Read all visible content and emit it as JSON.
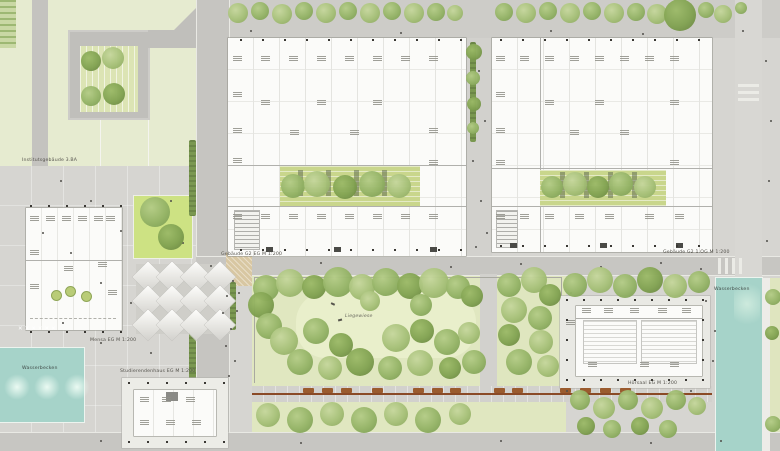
{
  "labels": {
    "institute": "Institutsgebäude 3.BA",
    "building_g2_eg": "Gebäude G2 EG M 1:200",
    "building_g2_og": "Gebäude G2 1.OG M 1:200",
    "mensa": "Mensa EG M 1:200",
    "studierendenhaus": "Studierendenhaus EG M 1:200",
    "hoersaal": "Hörsaal EG M 1:200",
    "liegewiese": "Liegewiese",
    "water_right": "Wasserbecken",
    "water_left": "Wasserbecken",
    "x_marks": "✕ ✕ ✕ ✕ ✕ ✕"
  },
  "colors": {
    "paving": "#d6d5d1",
    "road": "#c7c6c2",
    "lawn": "#e2e9c4",
    "roof_garden": "#c9d68c",
    "tree_green": "#94b366",
    "water_teal": "#a6d3c9",
    "building_white": "#fbfbf9",
    "bench_brown": "#9a5b2e",
    "sand": "#d8c7a2"
  },
  "scene": {
    "tree_palette": [
      [
        "#c6d79d",
        "#a6c078",
        "#89a65c"
      ],
      [
        "#b4cc87",
        "#94b366",
        "#789950"
      ],
      [
        "#9cba68",
        "#81a251",
        "#66823e"
      ]
    ],
    "trees": [
      [
        238,
        13,
        10,
        0
      ],
      [
        260,
        11,
        9,
        1
      ],
      [
        282,
        14,
        10,
        0
      ],
      [
        304,
        11,
        9,
        1
      ],
      [
        326,
        13,
        10,
        0
      ],
      [
        348,
        11,
        9,
        1
      ],
      [
        370,
        13,
        10,
        0
      ],
      [
        392,
        11,
        9,
        1
      ],
      [
        414,
        13,
        10,
        0
      ],
      [
        436,
        12,
        9,
        1
      ],
      [
        455,
        13,
        8,
        0
      ],
      [
        504,
        12,
        9,
        1
      ],
      [
        526,
        13,
        10,
        0
      ],
      [
        548,
        11,
        9,
        1
      ],
      [
        570,
        13,
        10,
        0
      ],
      [
        592,
        11,
        9,
        1
      ],
      [
        614,
        13,
        10,
        0
      ],
      [
        636,
        12,
        9,
        1
      ],
      [
        657,
        14,
        10,
        0
      ],
      [
        680,
        15,
        16,
        2
      ],
      [
        706,
        10,
        8,
        1
      ],
      [
        723,
        14,
        9,
        0
      ],
      [
        741,
        8,
        6,
        1
      ],
      [
        474,
        52,
        8,
        2
      ],
      [
        473,
        78,
        7,
        1
      ],
      [
        474,
        104,
        7,
        2
      ],
      [
        473,
        128,
        6,
        1
      ],
      [
        293,
        186,
        12,
        1
      ],
      [
        317,
        184,
        13,
        0
      ],
      [
        345,
        187,
        12,
        2
      ],
      [
        372,
        184,
        13,
        1
      ],
      [
        399,
        186,
        12,
        0
      ],
      [
        552,
        187,
        11,
        1
      ],
      [
        575,
        184,
        12,
        0
      ],
      [
        598,
        187,
        11,
        2
      ],
      [
        621,
        184,
        12,
        1
      ],
      [
        645,
        187,
        11,
        0
      ],
      [
        91,
        61,
        10,
        2
      ],
      [
        113,
        58,
        11,
        0
      ],
      [
        91,
        96,
        10,
        1
      ],
      [
        114,
        94,
        11,
        2
      ],
      [
        155,
        212,
        15,
        1
      ],
      [
        171,
        237,
        13,
        2
      ],
      [
        773,
        297,
        8,
        1
      ],
      [
        772,
        333,
        7,
        2
      ],
      [
        773,
        424,
        8,
        1
      ],
      [
        266,
        288,
        13,
        1
      ],
      [
        290,
        283,
        14,
        0
      ],
      [
        314,
        287,
        12,
        2
      ],
      [
        338,
        282,
        15,
        1
      ],
      [
        362,
        287,
        13,
        0
      ],
      [
        386,
        282,
        14,
        1
      ],
      [
        410,
        286,
        13,
        2
      ],
      [
        434,
        283,
        15,
        0
      ],
      [
        458,
        287,
        12,
        1
      ],
      [
        472,
        296,
        11,
        2
      ],
      [
        261,
        305,
        13,
        2
      ],
      [
        269,
        326,
        13,
        1
      ],
      [
        284,
        341,
        14,
        0
      ],
      [
        316,
        331,
        13,
        1
      ],
      [
        341,
        345,
        12,
        2
      ],
      [
        370,
        301,
        10,
        0
      ],
      [
        421,
        305,
        11,
        1
      ],
      [
        396,
        338,
        14,
        0
      ],
      [
        422,
        331,
        12,
        2
      ],
      [
        447,
        342,
        13,
        1
      ],
      [
        469,
        333,
        11,
        0
      ],
      [
        300,
        362,
        13,
        1
      ],
      [
        330,
        368,
        12,
        0
      ],
      [
        360,
        362,
        14,
        2
      ],
      [
        390,
        368,
        12,
        1
      ],
      [
        420,
        363,
        13,
        0
      ],
      [
        450,
        368,
        11,
        2
      ],
      [
        474,
        362,
        12,
        1
      ],
      [
        509,
        285,
        12,
        1
      ],
      [
        534,
        280,
        13,
        0
      ],
      [
        550,
        295,
        11,
        2
      ],
      [
        514,
        310,
        13,
        0
      ],
      [
        540,
        318,
        12,
        1
      ],
      [
        509,
        335,
        11,
        2
      ],
      [
        541,
        342,
        12,
        0
      ],
      [
        519,
        362,
        13,
        1
      ],
      [
        548,
        366,
        11,
        0
      ],
      [
        268,
        415,
        12,
        0
      ],
      [
        300,
        420,
        13,
        1
      ],
      [
        332,
        414,
        12,
        0
      ],
      [
        364,
        420,
        13,
        1
      ],
      [
        396,
        414,
        12,
        0
      ],
      [
        428,
        420,
        13,
        1
      ],
      [
        460,
        414,
        11,
        0
      ],
      [
        575,
        285,
        12,
        1
      ],
      [
        600,
        280,
        13,
        0
      ],
      [
        625,
        286,
        12,
        1
      ],
      [
        650,
        280,
        13,
        2
      ],
      [
        675,
        286,
        12,
        0
      ],
      [
        699,
        282,
        11,
        1
      ],
      [
        580,
        400,
        10,
        1
      ],
      [
        604,
        408,
        11,
        0
      ],
      [
        628,
        400,
        10,
        1
      ],
      [
        652,
        408,
        11,
        0
      ],
      [
        676,
        400,
        10,
        1
      ],
      [
        697,
        406,
        9,
        0
      ],
      [
        586,
        426,
        9,
        2
      ],
      [
        612,
        429,
        9,
        1
      ],
      [
        640,
        426,
        9,
        2
      ],
      [
        668,
        429,
        9,
        1
      ]
    ],
    "benches": [
      [
        303,
        388
      ],
      [
        322,
        388
      ],
      [
        341,
        388
      ],
      [
        372,
        388
      ],
      [
        413,
        388
      ],
      [
        432,
        388
      ],
      [
        450,
        388
      ],
      [
        494,
        388
      ],
      [
        512,
        388
      ],
      [
        560,
        388
      ],
      [
        580,
        388
      ],
      [
        600,
        388
      ],
      [
        620,
        388
      ]
    ],
    "dots": [
      [
        478,
        70
      ],
      [
        484,
        120
      ],
      [
        472,
        160
      ],
      [
        480,
        200
      ],
      [
        486,
        232
      ],
      [
        475,
        246
      ],
      [
        210,
        265
      ],
      [
        320,
        262
      ],
      [
        450,
        266
      ],
      [
        520,
        263
      ],
      [
        600,
        266
      ],
      [
        660,
        262
      ],
      [
        700,
        268
      ],
      [
        232,
        280
      ],
      [
        226,
        295
      ],
      [
        236,
        310
      ],
      [
        230,
        328
      ],
      [
        225,
        345
      ],
      [
        234,
        360
      ],
      [
        228,
        375
      ],
      [
        238,
        292
      ],
      [
        222,
        312
      ],
      [
        60,
        180
      ],
      [
        90,
        200
      ],
      [
        120,
        230
      ],
      [
        70,
        252
      ],
      [
        100,
        282
      ],
      [
        130,
        302
      ],
      [
        62,
        322
      ],
      [
        100,
        342
      ],
      [
        42,
        232
      ],
      [
        150,
        352
      ],
      [
        170,
        200
      ],
      [
        182,
        242
      ],
      [
        570,
        292
      ],
      [
        705,
        300
      ],
      [
        566,
        390
      ],
      [
        622,
        392
      ],
      [
        690,
        390
      ],
      [
        712,
        360
      ],
      [
        714,
        330
      ],
      [
        250,
        30
      ],
      [
        400,
        32
      ],
      [
        550,
        30
      ],
      [
        642,
        33
      ],
      [
        742,
        30
      ],
      [
        765,
        60
      ],
      [
        770,
        120
      ],
      [
        768,
        180
      ],
      [
        766,
        240
      ],
      [
        100,
        440
      ],
      [
        300,
        442
      ],
      [
        500,
        440
      ],
      [
        650,
        442
      ],
      [
        720,
        440
      ]
    ],
    "marks": [
      [
        233,
        56
      ],
      [
        233,
        92
      ],
      [
        233,
        128
      ],
      [
        233,
        158
      ],
      [
        233,
        214
      ],
      [
        261,
        56
      ],
      [
        261,
        100
      ],
      [
        289,
        56
      ],
      [
        317,
        56
      ],
      [
        317,
        100
      ],
      [
        345,
        56
      ],
      [
        373,
        56
      ],
      [
        373,
        100
      ],
      [
        401,
        56
      ],
      [
        429,
        56
      ],
      [
        429,
        128
      ],
      [
        429,
        160
      ],
      [
        261,
        214
      ],
      [
        289,
        214
      ],
      [
        317,
        214
      ],
      [
        345,
        214
      ],
      [
        373,
        214
      ],
      [
        401,
        214
      ],
      [
        429,
        214
      ],
      [
        350,
        130
      ],
      [
        290,
        130
      ],
      [
        496,
        56
      ],
      [
        496,
        92
      ],
      [
        496,
        128
      ],
      [
        496,
        160
      ],
      [
        496,
        214
      ],
      [
        520,
        56
      ],
      [
        545,
        56
      ],
      [
        545,
        100
      ],
      [
        570,
        56
      ],
      [
        595,
        56
      ],
      [
        595,
        100
      ],
      [
        620,
        56
      ],
      [
        645,
        56
      ],
      [
        670,
        56
      ],
      [
        670,
        100
      ],
      [
        670,
        160
      ],
      [
        520,
        214
      ],
      [
        545,
        214
      ],
      [
        575,
        214
      ],
      [
        605,
        214
      ],
      [
        645,
        214
      ],
      [
        675,
        214
      ],
      [
        620,
        130
      ],
      [
        570,
        130
      ],
      [
        30,
        216
      ],
      [
        46,
        216
      ],
      [
        62,
        216
      ],
      [
        78,
        216
      ],
      [
        94,
        216
      ],
      [
        106,
        216
      ],
      [
        30,
        250
      ],
      [
        30,
        284
      ],
      [
        64,
        266
      ],
      [
        98,
        262
      ],
      [
        108,
        290
      ],
      [
        582,
        308
      ],
      [
        604,
        308
      ],
      [
        630,
        308
      ],
      [
        658,
        308
      ],
      [
        682,
        308
      ],
      [
        588,
        362
      ],
      [
        640,
        362
      ],
      [
        670,
        362
      ],
      [
        566,
        320
      ],
      [
        140,
        397
      ],
      [
        162,
        397
      ],
      [
        186,
        397
      ],
      [
        140,
        420
      ],
      [
        166,
        420
      ],
      [
        192,
        420
      ]
    ],
    "slots": [
      [
        298,
        170
      ],
      [
        326,
        170
      ],
      [
        354,
        170
      ],
      [
        382,
        170
      ],
      [
        560,
        172
      ],
      [
        584,
        172
      ],
      [
        608,
        172
      ],
      [
        632,
        172
      ]
    ],
    "canopies": {
      "cols": [
        148,
        172,
        196,
        220
      ],
      "rows": [
        277,
        301,
        325
      ],
      "size": 22
    },
    "columns": [
      {
        "x": 240,
        "y": 39,
        "n": 11,
        "dx": 22,
        "dy": 0
      },
      {
        "x": 240,
        "y": 249,
        "n": 11,
        "dx": 22,
        "dy": 0
      },
      {
        "x": 500,
        "y": 39,
        "n": 10,
        "dx": 22,
        "dy": 0
      },
      {
        "x": 500,
        "y": 245,
        "n": 10,
        "dx": 22,
        "dy": 0
      },
      {
        "x": 566,
        "y": 299,
        "n": 9,
        "dx": 17,
        "dy": 0
      },
      {
        "x": 566,
        "y": 379,
        "n": 9,
        "dx": 17,
        "dy": 0
      },
      {
        "x": 566,
        "y": 299,
        "n": 5,
        "dx": 0,
        "dy": 20
      },
      {
        "x": 702,
        "y": 299,
        "n": 5,
        "dx": 0,
        "dy": 20
      },
      {
        "x": 128,
        "y": 382,
        "n": 6,
        "dx": 19,
        "dy": 0
      },
      {
        "x": 128,
        "y": 441,
        "n": 6,
        "dx": 19,
        "dy": 0
      },
      {
        "x": 30,
        "y": 205,
        "n": 6,
        "dx": 18,
        "dy": 0
      },
      {
        "x": 30,
        "y": 331,
        "n": 6,
        "dx": 18,
        "dy": 0
      }
    ]
  }
}
